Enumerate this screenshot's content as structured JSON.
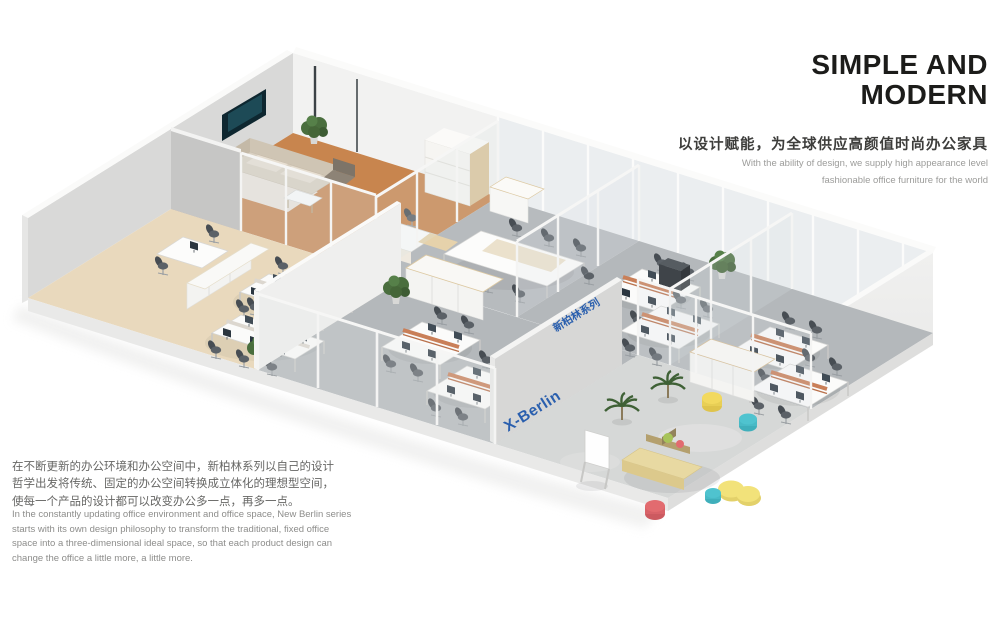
{
  "header": {
    "title_line1": "SIMPLE AND",
    "title_line2": "MODERN",
    "tagline_zh": "以设计赋能，为全球供应高颜值时尚办公家具",
    "subtitle_en_line1": "With the ability of design, we supply high appearance level",
    "subtitle_en_line2": "fashionable office furniture for the world"
  },
  "description": {
    "paragraph_zh": "在不断更新的办公环境和办公空间中，新柏林系列以自己的设计哲学出发将传统、固定的办公空间转换成立体化的理想型空间，使每一个产品的设计都可以改变办公多一点，再多一点。",
    "paragraph_en": "In the constantly updating office environment and office space, New Berlin series starts with its own design philosophy to transform the traditional, fixed office space into a three-dimensional ideal space, so that each product design can change the office a little more, a little more."
  },
  "scene": {
    "wall_logo_en": "X-Berlin",
    "wall_logo_zh": "新柏林系列",
    "colors": {
      "logo_blue": "#2a5fae",
      "wood_floor": "#c8854e",
      "cream_floor": "#e9d9bd",
      "carpet_gray": "#b6babd",
      "concrete": "#d6d8d7",
      "divider_orange": "#c97f58",
      "pouf_yellow": "#f2d95e",
      "pouf_teal": "#4fc3cf",
      "pouf_pink": "#e26b6f",
      "plant_green": "#4a6e3e"
    }
  }
}
